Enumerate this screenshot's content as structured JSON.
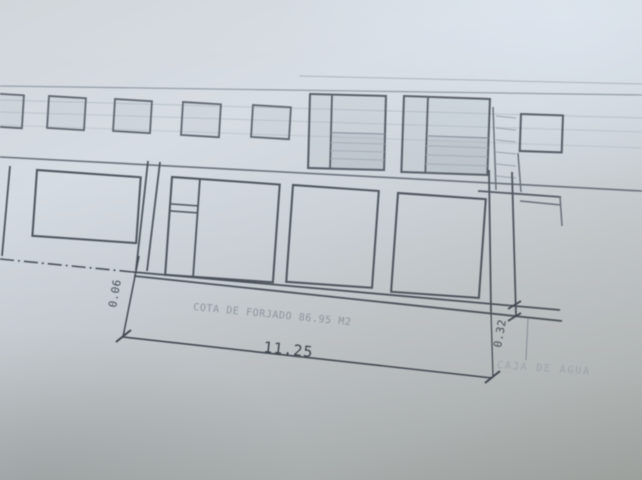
{
  "scene": {
    "description": "Photograph of an architectural elevation drawing on paper",
    "paper_color": "#ccd2d8",
    "ink_color": "#50565f",
    "faint_ink_color": "#9aa2ac"
  },
  "drawing": {
    "dimensions": {
      "total_width": "11.25",
      "left_offset": "0.06",
      "slab_edge": "0.32"
    },
    "annotations": {
      "slab_note": "COTA DE FORJADO 86.95 M2",
      "corner_note": "CAJA DE AGUA"
    }
  }
}
